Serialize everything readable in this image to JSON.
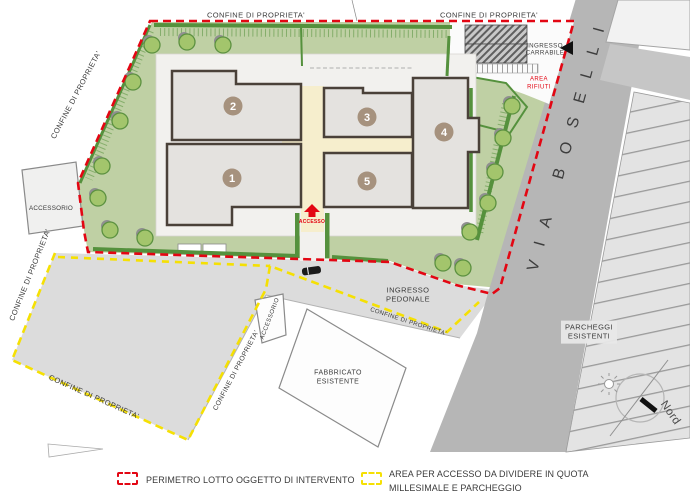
{
  "plan": {
    "boundary_label": "CONFINE DI PROPRIETA'",
    "street_name": "VIA BOSELLI",
    "labels": {
      "accessorio_left": "ACCESSORIO",
      "accessorio_small": "ACCESSORIO",
      "ingresso_carrabile_1": "INGRESSO",
      "ingresso_carrabile_2": "CARRABILE",
      "area_rifiuti_1": "AREA",
      "area_rifiuti_2": "RIFIUTI",
      "ingresso_pedonale_1": "INGRESSO",
      "ingresso_pedonale_2": "PEDONALE",
      "fabbricato_1": "FABBRICATO",
      "fabbricato_2": "ESISTENTE",
      "parcheggi_1": "PARCHEGGI",
      "parcheggi_2": "ESISTENTI",
      "accesso": "ACCESSO",
      "nord": "Nord"
    },
    "building_numbers": [
      "1",
      "2",
      "3",
      "4",
      "5"
    ],
    "legend": {
      "item1": "PERIMETRO LOTTO OGGETTO DI INTERVENTO",
      "item2_line1": "AREA PER ACCESSO DA DIVIDERE IN QUOTA",
      "item2_line2": "MILLESIMALE E PARCHEGGIO"
    },
    "colors": {
      "perimeter_red": "#e30613",
      "access_yellow": "#f5e003",
      "lawn_green": "#bfd0a4",
      "hedge_green": "#55913d",
      "tree_green": "#a3c56c",
      "road_gray": "#b6b6b6",
      "parcel_gray": "#dcdcdc",
      "building_fill": "#e4e2df",
      "wall_brown": "#4a4139",
      "courtyard_cream": "#f6eecd",
      "number_circle_taupe": "#a6927e"
    }
  }
}
